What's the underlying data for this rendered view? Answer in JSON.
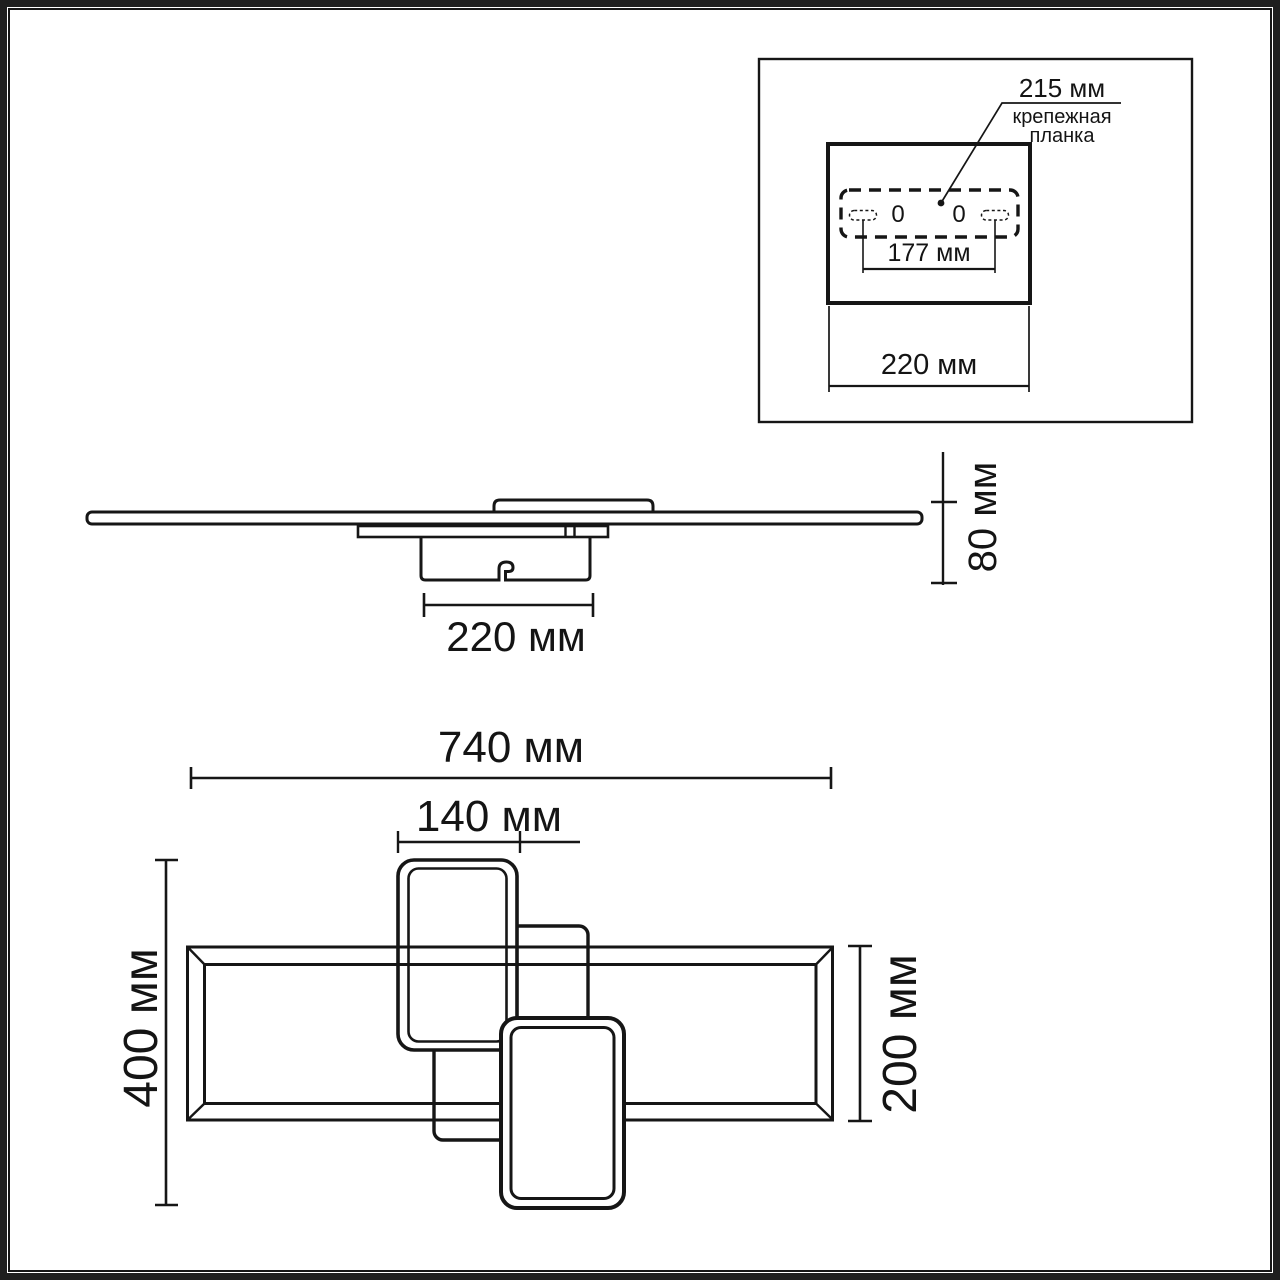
{
  "colors": {
    "line": "#161616",
    "background": "#ffffff"
  },
  "inset": {
    "plate_length": "215 мм",
    "plate_caption_line1": "крепежная",
    "plate_caption_line2": "планка",
    "left_hole": "0",
    "right_hole": "0",
    "slot_spacing": "177 мм",
    "box_width": "220 мм"
  },
  "side_view": {
    "canopy_width": "220 мм",
    "fixture_height": "80 мм"
  },
  "top_view": {
    "overall_width": "740 мм",
    "inner_frame_width": "140 мм",
    "overall_depth": "400 мм",
    "main_frame_depth": "200 мм"
  }
}
